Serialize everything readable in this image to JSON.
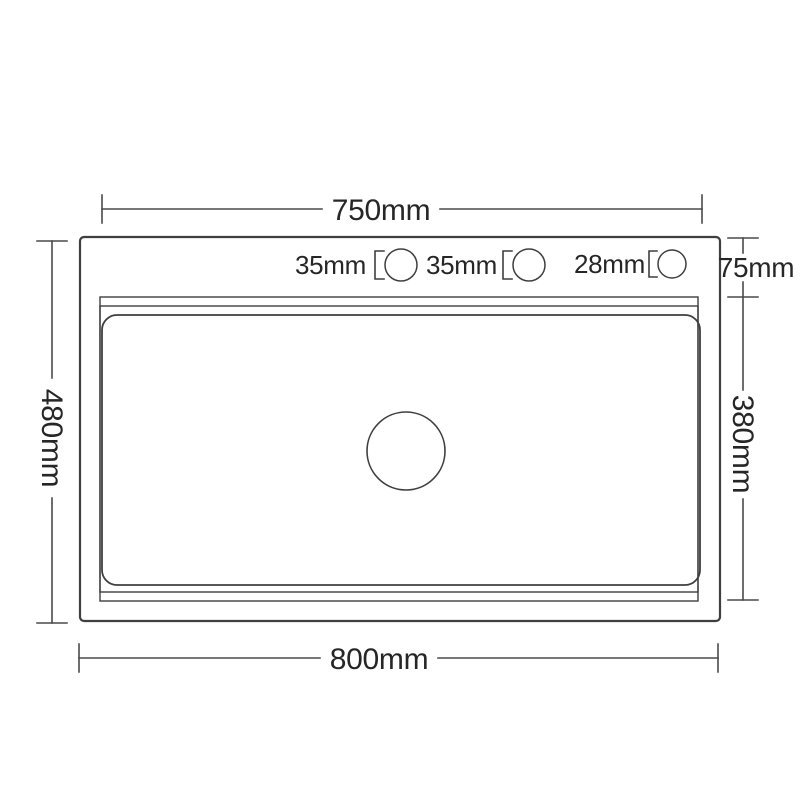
{
  "diagram": {
    "subject": "kitchen-sink-top-view-dimension-drawing",
    "background": "#ffffff",
    "line_color": "#3f3f3f",
    "dim_line_color": "#4a4a4a",
    "text_color": "#262626",
    "dimensions": {
      "top_width": "750mm",
      "bottom_width": "800mm",
      "left_height": "480mm",
      "right_top_inset": "75mm",
      "right_inner_height": "380mm"
    },
    "holes": [
      {
        "label": "35mm"
      },
      {
        "label": "35mm"
      },
      {
        "label": "28mm"
      }
    ]
  }
}
